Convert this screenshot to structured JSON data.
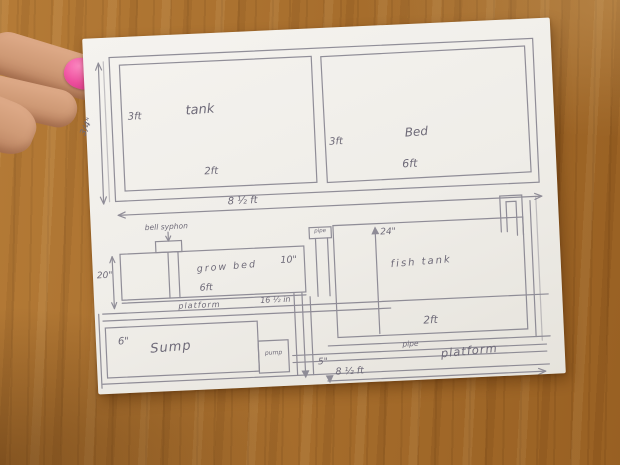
{
  "colors": {
    "table_wood": "#a86d2a",
    "paper": "#f2f0eb",
    "pencil": "#7b7886",
    "nail_polish": "#ee4f9e",
    "skin": "#d6a184"
  },
  "plan_view": {
    "tank_label": "tank",
    "tank_height": "3ft",
    "tank_width": "2ft",
    "bed_height": "3ft",
    "bed_label": "Bed",
    "bed_width": "6ft",
    "edge_dim": "3/4\"",
    "total_width": "8 ½ ft"
  },
  "elevation_view": {
    "bell_syphon_label": "bell syphon",
    "grow_bed_label": "grow bed",
    "grow_bed_left_dim": "20\"",
    "grow_bed_right_dim": "10\"",
    "grow_bed_width": "6ft",
    "platform_small_label": "platform",
    "platform_dim": "16 ½ in",
    "standpipe_label": "pipe",
    "fish_tank_label": "fish tank",
    "fish_tank_depth": "24\"",
    "fish_tank_width": "2ft",
    "sump_label": "Sump",
    "sump_dim": "6\"",
    "pump_label": "pump",
    "pipe_label": "pipe",
    "platform_big_label": "platform",
    "drop_dim": "5\"",
    "total_width": "8 ½ ft"
  }
}
